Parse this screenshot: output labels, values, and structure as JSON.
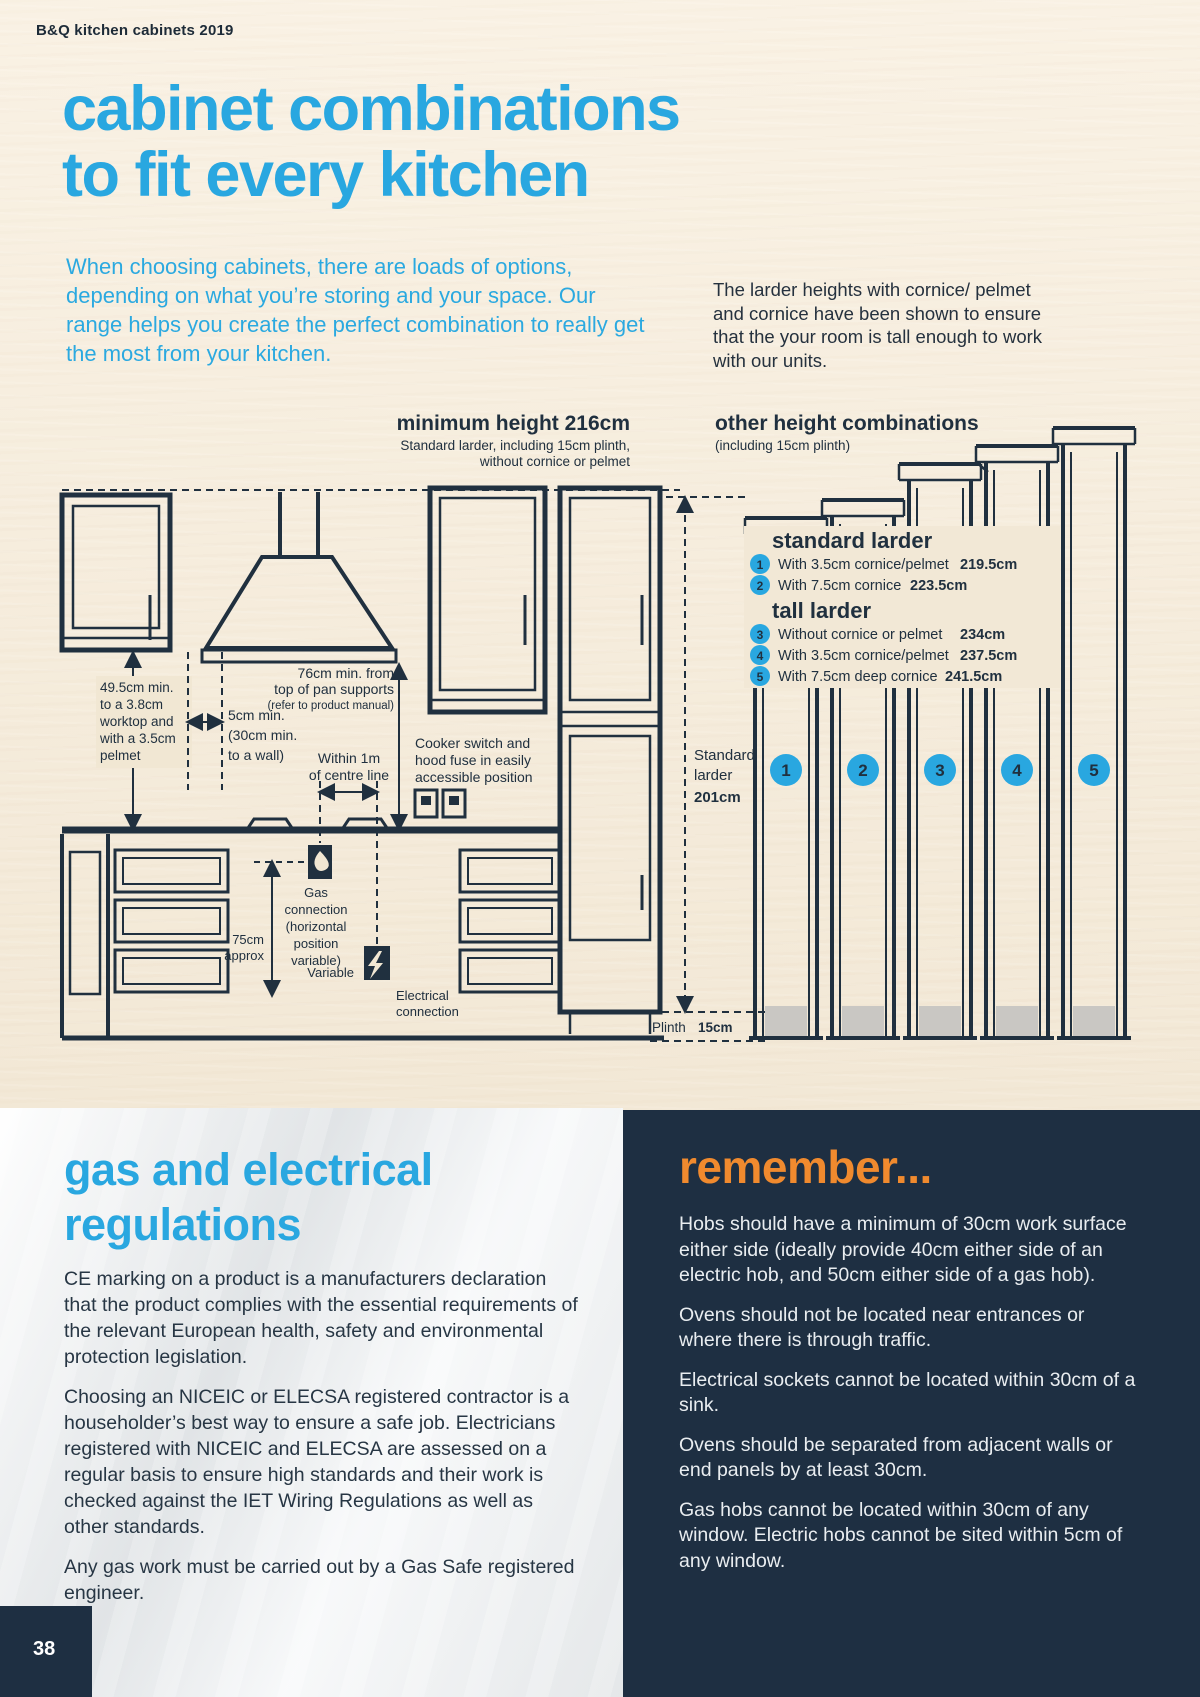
{
  "page": {
    "brand": "B&Q kitchen cabinets 2019",
    "page_number": "38"
  },
  "hero": {
    "title_line1": "cabinet combinations",
    "title_line2": "to fit every kitchen",
    "intro": "When choosing cabinets, there are loads of options, depending on what you’re storing and your space. Our range helps you create the perfect combination to really get the most from your kitchen.",
    "side_note": "The larder heights with cornice/ pelmet and cornice have been shown to ensure that the your room is tall enough to work with our units."
  },
  "diagram": {
    "left_heading": "minimum height 216cm",
    "left_sub1": "Standard larder, including 15cm plinth,",
    "left_sub2": "without cornice or pelmet",
    "right_heading": "other height combinations",
    "right_sub": "(including 15cm plinth)",
    "legend": {
      "standard_title": "standard larder",
      "tall_title": "tall larder",
      "items": [
        {
          "n": "1",
          "label": "With 3.5cm cornice/pelmet",
          "value": "219.5cm"
        },
        {
          "n": "2",
          "label": "With 7.5cm cornice",
          "value": "223.5cm"
        },
        {
          "n": "3",
          "label": "Without cornice or pelmet",
          "value": "234cm"
        },
        {
          "n": "4",
          "label": "With 3.5cm cornice/pelmet",
          "value": "237.5cm"
        },
        {
          "n": "5",
          "label": "With 7.5cm deep cornice",
          "value": "241.5cm"
        }
      ]
    },
    "annotations": {
      "min495": [
        "49.5cm min.",
        "to a 3.8cm",
        "worktop and",
        "with a 3.5cm",
        "pelmet"
      ],
      "min5": [
        "5cm min.",
        "(30cm min.",
        "to a wall)"
      ],
      "min76": [
        "76cm min. from",
        "top of pan supports",
        "(refer to product manual)"
      ],
      "within1m": [
        "Within 1m",
        "of centre line"
      ],
      "cooker": [
        "Cooker switch and",
        "hood fuse in easily",
        "accessible position"
      ],
      "gas": [
        "Gas",
        "connection",
        "(horizontal",
        "position",
        "variable)"
      ],
      "cm75": [
        "75cm",
        "approx"
      ],
      "variable": "Variable",
      "electrical": [
        "Electrical",
        "connection"
      ],
      "standard_larder": [
        "Standard",
        "larder",
        "201cm"
      ],
      "plinth_label": "Plinth",
      "plinth_value": "15cm"
    },
    "combo_numbers": [
      "1",
      "2",
      "3",
      "4",
      "5"
    ]
  },
  "regulations": {
    "title": "gas and electrical regulations",
    "paragraphs": [
      "CE marking on a product is a manufacturers declaration that the product complies with the essential requirements of the relevant European health, safety and environmental protection legislation.",
      "Choosing an NICEIC or ELECSA registered contractor is a householder’s best way to ensure a safe job. Electricians registered with NICEIC and ELECSA are assessed on a regular basis to ensure high standards and their work is checked against the IET Wiring Regulations as well as other standards.",
      "Any gas work must be carried out by a Gas Safe registered engineer."
    ]
  },
  "remember": {
    "title": "remember...",
    "paragraphs": [
      "Hobs should have a minimum of 30cm work surface either side (ideally provide 40cm either side of an electric hob, and 50cm either side of a gas hob).",
      "Ovens should not be located near entrances or where there is through traffic.",
      "Electrical sockets cannot be located within 30cm of a sink.",
      "Ovens should be separated from adjacent walls or end panels by at least 30cm.",
      "Gas hobs cannot be located within 30cm of any window. Electric hobs cannot be sited within 5cm of any window."
    ]
  },
  "colors": {
    "accent_blue": "#29a7e0",
    "accent_orange": "#f08a2e",
    "navy": "#1e2f42"
  }
}
